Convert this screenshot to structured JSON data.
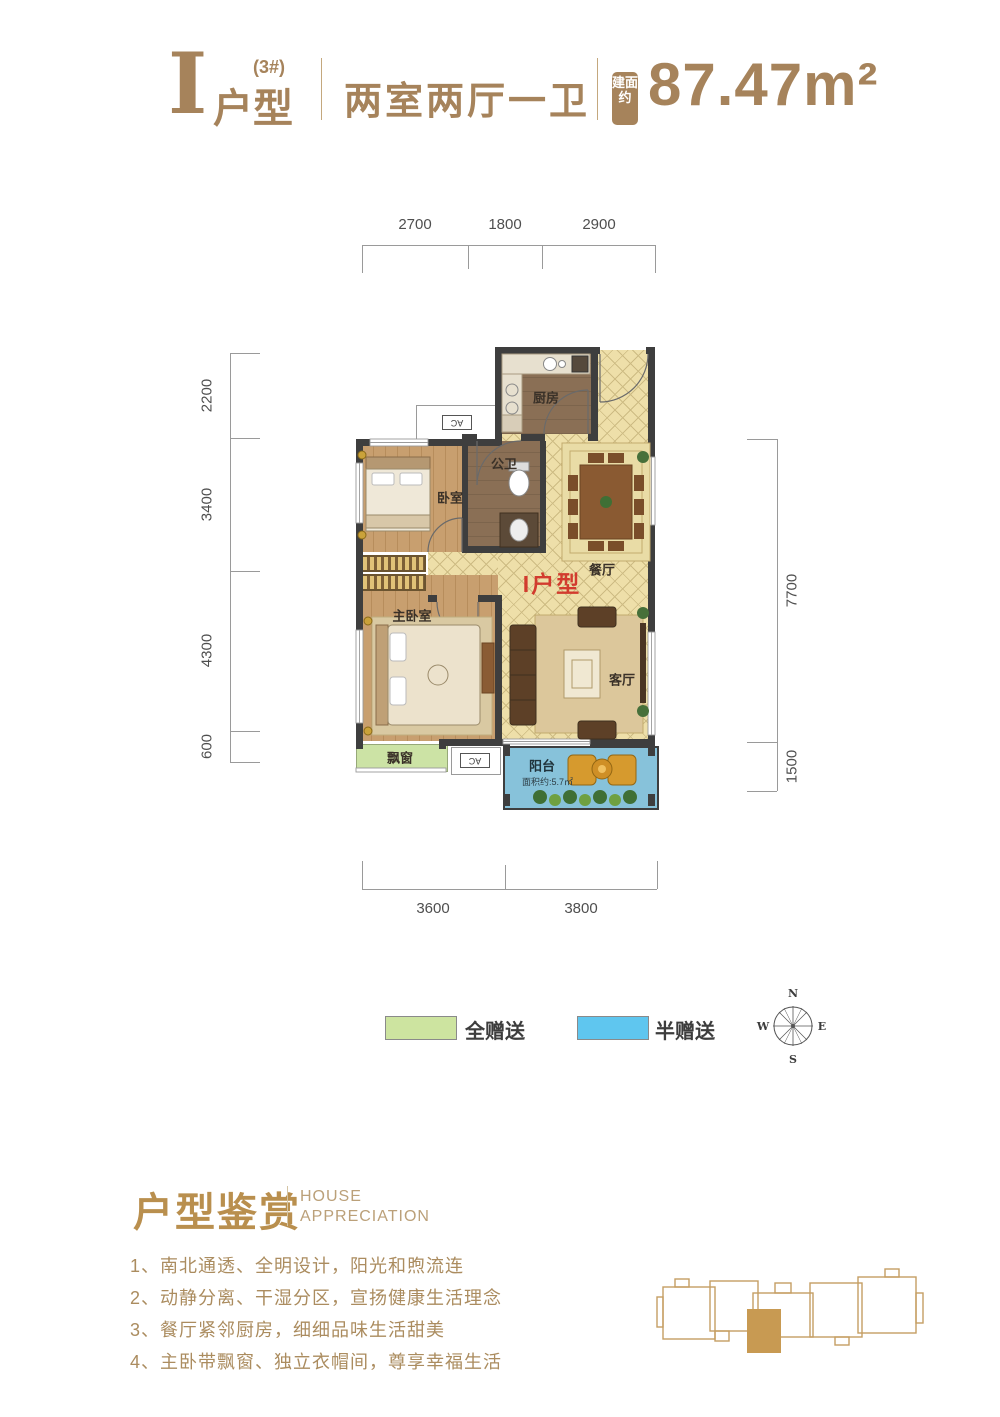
{
  "theme": {
    "gold": "#a6835b",
    "red": "#d23b2e",
    "wall": "#3e3e3e",
    "tile": "#eedfa9",
    "tile-line": "#cdbb83",
    "wood": "#c89f6f",
    "wood-dark": "#b78d5c",
    "brown": "#8a6f55",
    "bay-green": "#cce3a5",
    "balcony-blue": "#87c2da",
    "legend-green": "#cde4a0",
    "legend-blue": "#5fc6ef",
    "dim-line": "#9a9a9a",
    "dim-text": "#4f4f4f",
    "label": "#3a3128"
  },
  "header": {
    "unit_letter": "I",
    "building_no": "(3#)",
    "unit_word": "户型",
    "layout": "两室两厅一卫",
    "area_badge": "建面约",
    "area": "87.47m²"
  },
  "plan": {
    "rooms": {
      "kitchen": "厨房",
      "bath": "公卫",
      "bedroom2": "卧室",
      "master": "主卧室",
      "dining": "餐厅",
      "living": "客厅",
      "bay_window": "飘窗",
      "balcony": "阳台",
      "balcony_area": "面积约:5.7㎡",
      "unit_tag": "I户型",
      "ac": "AC"
    },
    "dims": {
      "top": [
        "2700",
        "1800",
        "2900"
      ],
      "left": [
        "2200",
        "3400",
        "4300",
        "600"
      ],
      "right": [
        "7700",
        "1500"
      ],
      "bottom": [
        "3600",
        "3800"
      ]
    }
  },
  "legend": {
    "full_gift": {
      "label": "全赠送",
      "color": "#cde4a0"
    },
    "half_gift": {
      "label": "半赠送",
      "color": "#5fc6ef"
    }
  },
  "compass": {
    "n": "N",
    "e": "E",
    "s": "S",
    "w": "W"
  },
  "appreciation": {
    "title": "户型鉴赏",
    "subtitle_line1": "HOUSE",
    "subtitle_line2": "APPRECIATION",
    "items": [
      "1、南北通透、全明设计，阳光和煦流连",
      "2、动静分离、干湿分区，宣扬健康生活理念",
      "3、餐厅紧邻厨房，细细品味生活甜美",
      "4、主卧带飘窗、独立衣帽间，尊享幸福生活"
    ]
  }
}
